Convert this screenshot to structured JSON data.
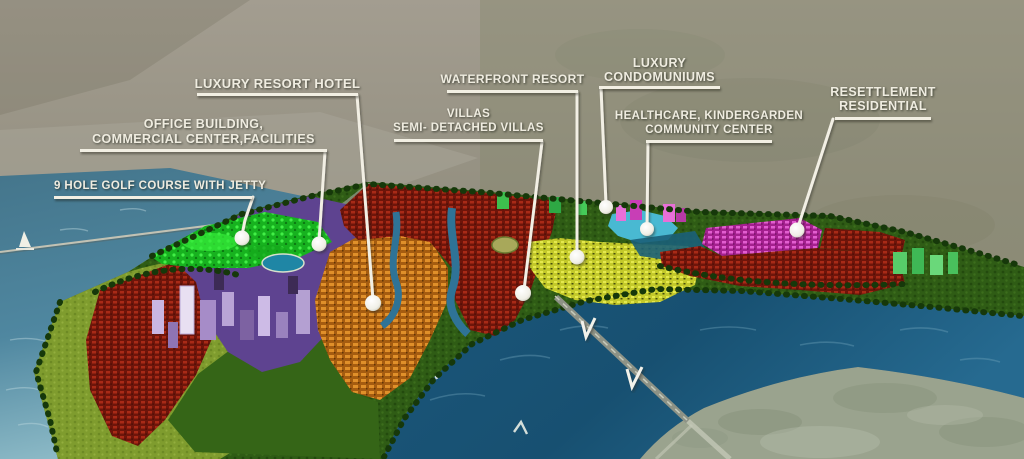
{
  "labels": [
    {
      "id": "golf",
      "lines": [
        "9 HOLE GOLF COURSE WITH JETTY"
      ]
    },
    {
      "id": "office",
      "lines": [
        "OFFICE BUILDING,",
        "COMMERCIAL CENTER,FACILITIES"
      ]
    },
    {
      "id": "hotel",
      "lines": [
        "LUXURY RESORT HOTEL"
      ]
    },
    {
      "id": "waterfront",
      "lines": [
        "WATERFRONT RESORT"
      ]
    },
    {
      "id": "villas",
      "lines": [
        "VILLAS",
        "SEMI- DETACHED VILLAS"
      ]
    },
    {
      "id": "condominiums",
      "lines": [
        "LUXURY",
        "CONDOMUNIUMS"
      ]
    },
    {
      "id": "healthcare",
      "lines": [
        "HEALTHCARE, KINDERGARDEN",
        "COMMUNITY CENTER"
      ]
    },
    {
      "id": "resettlement",
      "lines": [
        "RESETTLEMENT",
        "RESIDENTIAL"
      ]
    }
  ],
  "colors": {
    "label_text": "#efece0",
    "leader_line": "#f2efe4",
    "water_left": "#47798e",
    "river": "#1d5c7e",
    "golf_green": "#17b21f",
    "residential_red": "#a82a17",
    "resort_orange": "#e0902a",
    "villas_yellow": "#c9cf2a",
    "condo_magenta": "#cf3db4",
    "healthcare_cyan": "#49b9d2",
    "cbd_purple": "#6a4d99",
    "resettlement_pink": "#e25ed0",
    "background_haze": "#9b968a"
  }
}
